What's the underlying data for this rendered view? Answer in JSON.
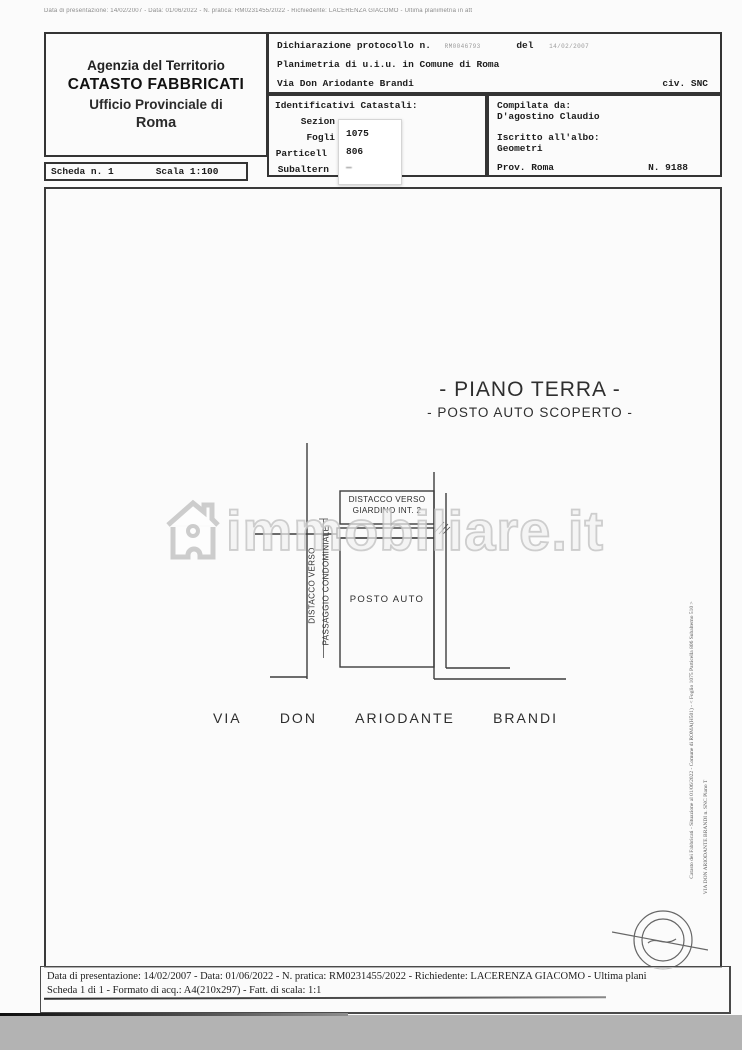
{
  "colors": {
    "paper": "#fbfbfb",
    "ink": "#2b2b2b",
    "bottom_strip": "#b3b3b3",
    "watermark_stroke": "#c1c1c1"
  },
  "microtext": "Data di presentazione: 14/02/2007 - Data: 01/06/2022 - N. pratica: RM0231455/2022 - Richiedente: LACERENZA GIACOMO - Ultima planimetria in att",
  "header": {
    "agency": {
      "line1": "Agenzia del Territorio",
      "line2": "CATASTO FABBRICATI",
      "line3": "Ufficio Provinciale di",
      "line4": "Roma"
    },
    "declaration": {
      "protocol_label": "Dichiarazione protocollo n.",
      "protocol_number": "RM0046793",
      "del_label": "del",
      "protocol_date": "14/02/2007",
      "object_line": "Planimetria di u.i.u. in Comune di Roma",
      "street_line": "Via Don Ariodante Brandi",
      "civ": "civ. SNC"
    },
    "identifiers": {
      "title": "Identificativi Catastali:",
      "rows": [
        {
          "label": "Sezion",
          "value": ""
        },
        {
          "label": "Fogli",
          "value": "1075"
        },
        {
          "label": "Particell",
          "value": "806"
        },
        {
          "label": "Subaltern",
          "value": "—"
        }
      ]
    },
    "compiler": {
      "title": "Compilata da:",
      "name": "D'agostino Claudio",
      "albo_label": "Iscritto all'albo:",
      "albo_value": "Geometri",
      "prov": "Prov. Roma",
      "number": "N. 9188"
    },
    "sheet": {
      "scheda": "Scheda n. 1",
      "scale": "Scala 1:100"
    }
  },
  "plan": {
    "title_line1": "- PIANO TERRA -",
    "title_line2": "- POSTO AUTO SCOPERTO -",
    "label_distacco_giardino_line1": "DISTACCO VERSO",
    "label_distacco_giardino_line2": "GIARDINO INT. 2",
    "label_distacco_passaggio_line1": "DISTACCO VERSO",
    "label_distacco_passaggio_line2": "PASSAGGIO CONDOMINIALE",
    "label_posto_auto": "POSTO AUTO",
    "street_words": [
      "VIA",
      "DON",
      "ARIODANTE",
      "BRANDI"
    ]
  },
  "watermark": {
    "text": "immobiliare.it"
  },
  "margin_notes": {
    "note1": "Catasto dei Fabbricati - Situazione al 01/06/2022 - Comune di ROMA(H501) - < Foglio 1075 Particella 806 Subalterno 510 >",
    "note2": "VIA DON ARIODANTE BRANDI n. SNC Piano T"
  },
  "footer": {
    "line1": "Data di presentazione: 14/02/2007 - Data: 01/06/2022 - N. pratica: RM0231455/2022 - Richiedente: LACERENZA GIACOMO - Ultima plani",
    "line2": "Scheda 1 di 1 - Formato di acq.: A4(210x297) - Fatt. di scala: 1:1"
  }
}
